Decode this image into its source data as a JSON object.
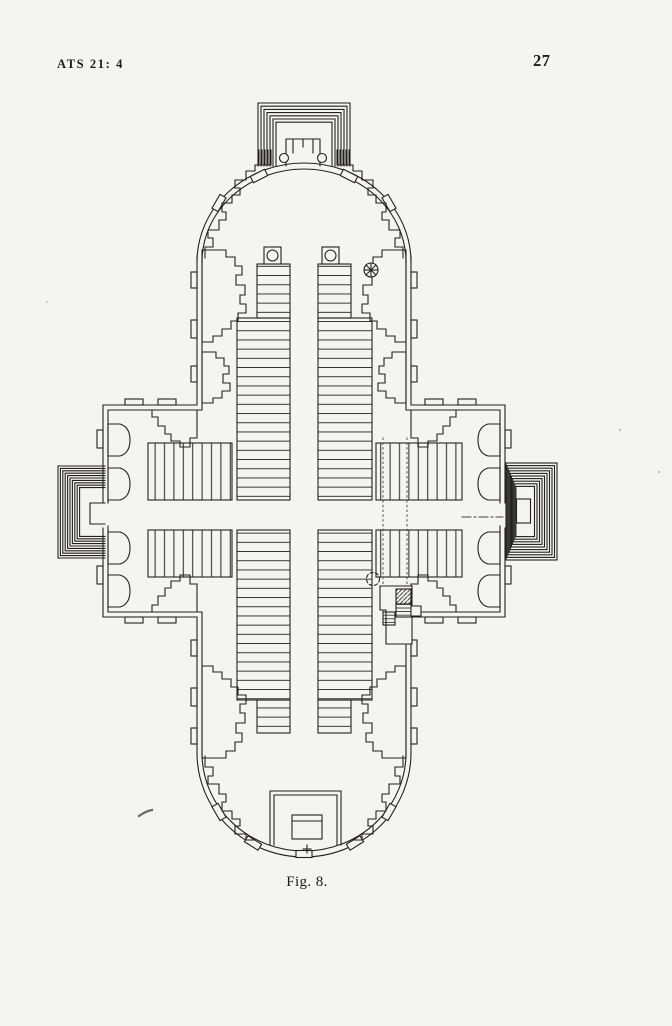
{
  "header": {
    "series_ref": "ATS 21: 4",
    "page_number": "27"
  },
  "figure": {
    "caption": "Fig. 8."
  },
  "colors": {
    "paper": "#f6f4ef",
    "ink": "#1e1c19"
  }
}
